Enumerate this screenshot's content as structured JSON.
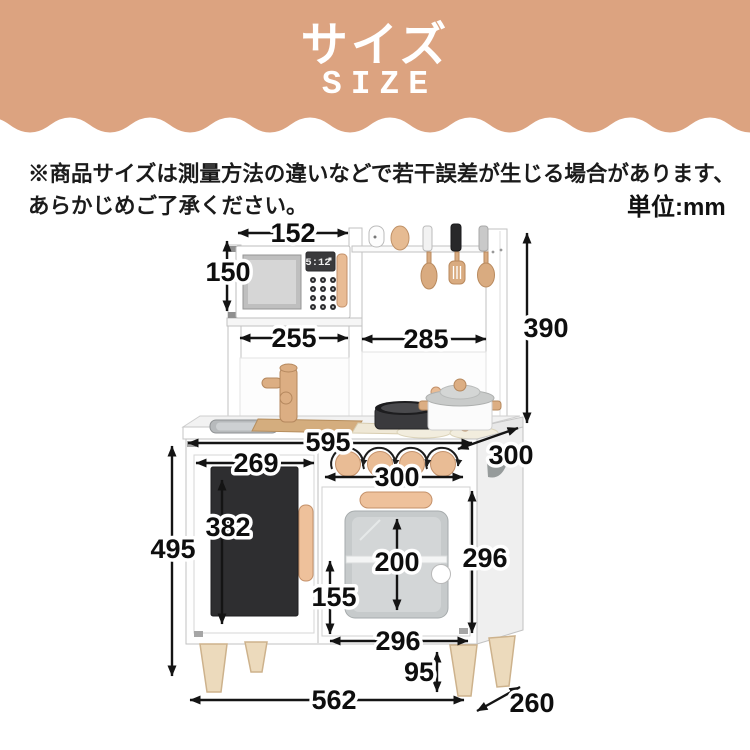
{
  "header": {
    "title_ja": "サイズ",
    "title_en": "SIZE"
  },
  "notice": {
    "line1": "※商品サイズは測量方法の違いなどで若干誤差が生じる場合があります、",
    "line2": "あらかじめご了承ください。",
    "unit_label": "単位:mm"
  },
  "kitchen": {
    "microwave_clock": "5:12",
    "dims": {
      "microwave_width": "152",
      "microwave_height": "150",
      "left_bay_width": "255",
      "right_bay_width": "285",
      "hutch_height": "390",
      "counter_width": "595",
      "counter_depth": "300",
      "left_door_width": "269",
      "stove_panel_width": "300",
      "left_door_height": "382",
      "base_height": "495",
      "oven_window_height": "200",
      "oven_door_height": "296",
      "oven_lower_height": "155",
      "oven_door_width": "296",
      "leg_height": "95",
      "base_width": "562",
      "base_depth": "260"
    },
    "colors": {
      "header_bg": "#dca380",
      "wood": "#e9bc95",
      "wood_dark": "#c4916a",
      "chalkboard": "#2e2e30",
      "dimension_line": "#141414"
    }
  }
}
